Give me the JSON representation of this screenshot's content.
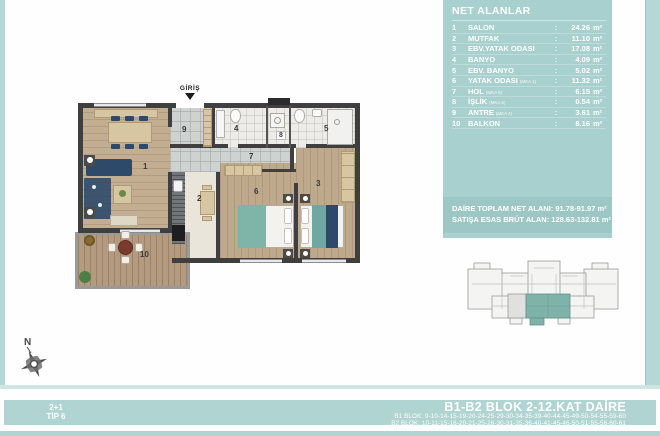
{
  "panel": {
    "title": "NET ALANLAR",
    "colon": ":",
    "unit": "m²",
    "rows": [
      {
        "no": "1",
        "name": "SALON",
        "sub": "",
        "value": "24.26"
      },
      {
        "no": "2",
        "name": "MUTFAK",
        "sub": "",
        "value": "11.10"
      },
      {
        "no": "3",
        "name": "EBV.YATAK ODASI",
        "sub": "",
        "value": "17.08"
      },
      {
        "no": "4",
        "name": "BANYO",
        "sub": "",
        "value": "4.09"
      },
      {
        "no": "5",
        "name": "EBV. BANYO",
        "sub": "",
        "value": "5.02"
      },
      {
        "no": "6",
        "name": "YATAK ODASI",
        "sub": "(MKA 1)",
        "value": "11.32"
      },
      {
        "no": "7",
        "name": "HOL",
        "sub": "(MKA 5)",
        "value": "6.15"
      },
      {
        "no": "8",
        "name": "İŞLİK",
        "sub": "(MKA 6)",
        "value": "0.54"
      },
      {
        "no": "9",
        "name": "ANTRE",
        "sub": "(MKA 4)",
        "value": "3.61"
      },
      {
        "no": "10",
        "name": "BALKON",
        "sub": "",
        "value": "8.16"
      }
    ],
    "summary_line1": "DAİRE TOPLAM NET ALANI: 91.78-91.97 m²",
    "summary_line2": "SATIŞA ESAS BRÜT ALAN: 128.63-132.81 m²"
  },
  "plan": {
    "entrance_label": "GİRİŞ",
    "compass_label": "N",
    "room_labels": [
      "1",
      "2",
      "3",
      "4",
      "5",
      "6",
      "7",
      "8",
      "9",
      "10"
    ]
  },
  "footer": {
    "unit_type": "2+1",
    "unit_tip": "TİP 6",
    "title": "B1-B2 BLOK 2-12.KAT DAİRE",
    "b1_line": "B1 BLOK: 9-10-14-15-19-20-24-25-29-30-34-35-39-40-44-45-49-50-54-55-59-60",
    "b2_line": "B2 BLOK: 10-11-15-16-20-21-25-26-30-31-35-36-40-41-45-46-50-51-55-56-60-61"
  },
  "colors": {
    "panel_teal": "#a8d0ce",
    "footer_teal": "#b0d4d2",
    "summary_teal": "#9dc7c5",
    "highlight_unit_teal": "#7fb3aa",
    "wall_dark": "#3f3f3f",
    "wood_floor": "#c3ae92",
    "navy_furniture": "#2e4a6a",
    "bed_teal": "#7fb4a8"
  }
}
